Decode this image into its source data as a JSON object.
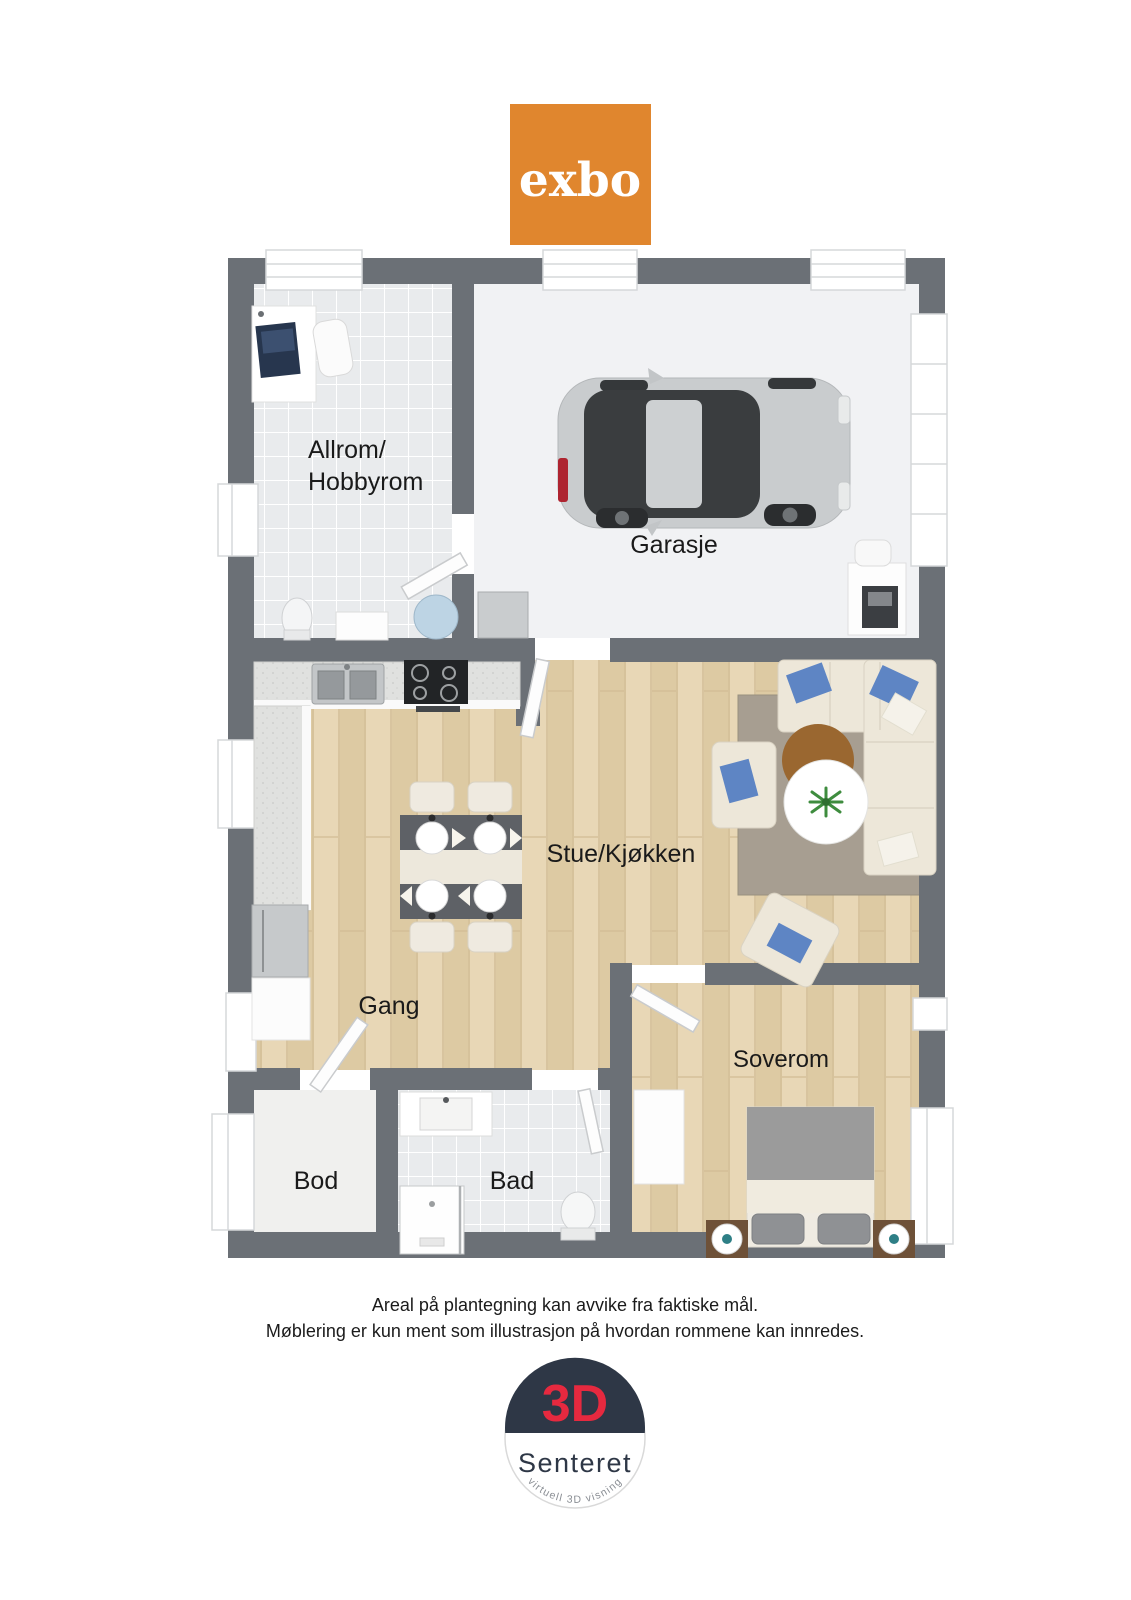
{
  "branding": {
    "logo_text": "exbo",
    "logo_bg": "#E0862E",
    "logo_text_color": "#FFFFFF"
  },
  "floorplan": {
    "rooms": {
      "allrom": {
        "line1": "Allrom/",
        "line2": "Hobbyrom"
      },
      "garasje": {
        "label": "Garasje"
      },
      "stue": {
        "label": "Stue/Kjøkken"
      },
      "gang": {
        "label": "Gang"
      },
      "soverom": {
        "label": "Soverom"
      },
      "bod": {
        "label": "Bod"
      },
      "bad": {
        "label": "Bad"
      }
    }
  },
  "disclaimer": {
    "line1": "Areal på plantegning kan avvike fra faktiske mål.",
    "line2": "Møblering er kun ment som illustrasjon på hvordan rommene kan innredes."
  },
  "footer_logo": {
    "title": "3D",
    "subtitle": "Senteret",
    "tagline": "virtuell 3D visning",
    "navy": "#2E3746",
    "red": "#E6293F",
    "tagline_color": "#8A8E94"
  },
  "colors": {
    "wall": "#6B7076",
    "label": "#1A1A1A",
    "wood": "#E3D1AE",
    "tile": "#E9EBED",
    "garage_floor": "#F1F2F4",
    "bod_floor": "#F0F0EE",
    "counter": "#E0E1DF",
    "rug": "#A79E91",
    "sofa": "#EDE7D9",
    "pillow_blue": "#5E85C4",
    "coffee_table": "#9A6730",
    "bed_blanket": "#9B9B9B",
    "nightstand": "#6E5138",
    "car_body": "#C9CCCE",
    "glass_dark": "#3A3D3F"
  }
}
